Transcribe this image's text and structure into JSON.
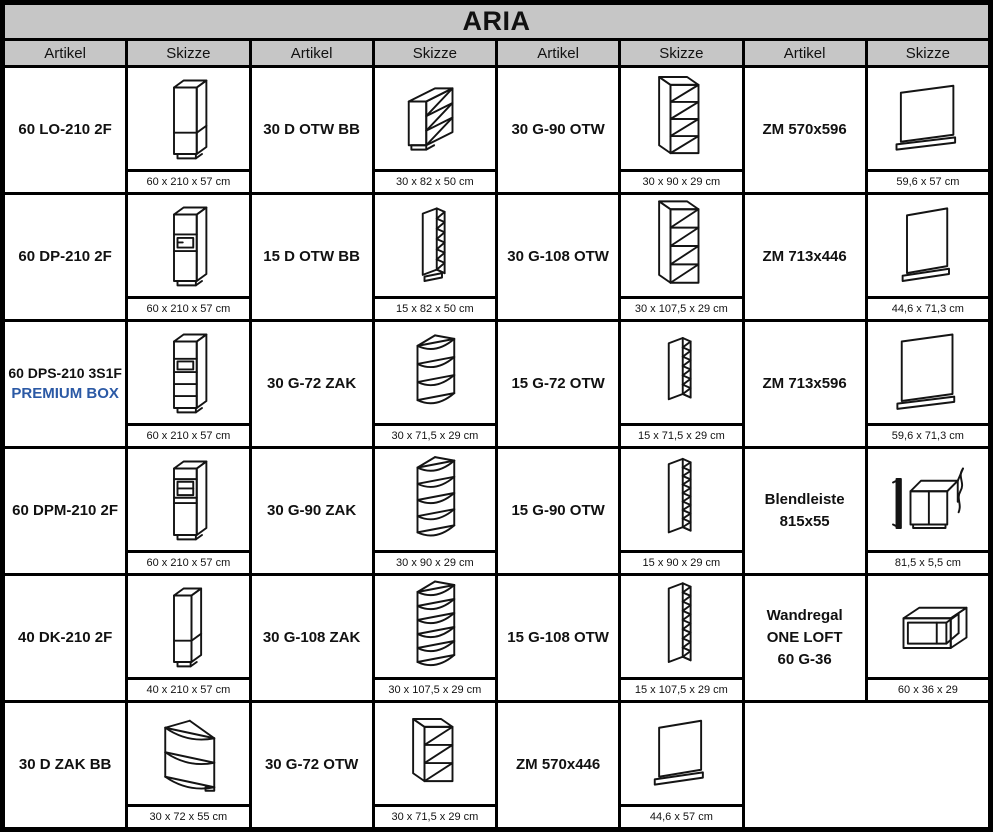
{
  "title": "ARIA",
  "columns": [
    "Artikel",
    "Skizze",
    "Artikel",
    "Skizze",
    "Artikel",
    "Skizze",
    "Artikel",
    "Skizze"
  ],
  "colors": {
    "accent_blue": "#2b59a5",
    "header_bg": "#c6c6c6",
    "grid_line": "#000000",
    "cell_bg": "#ffffff",
    "sketch_stroke": "#141414"
  },
  "rows": [
    [
      {
        "lines": [
          {
            "text": "60 LO-210 2F",
            "accent": false
          }
        ],
        "icon": "tall-cabinet-sketch",
        "sketch": {
          "kind": "tall",
          "variant": "2f",
          "w": 26
        },
        "dims": "60 x 210 x 57 cm"
      },
      {
        "lines": [
          {
            "text": "30 D OTW BB",
            "accent": false
          }
        ],
        "icon": "base-open-shelf-sketch",
        "sketch": {
          "kind": "base-open"
        },
        "dims": "30 x 82 x 50 cm"
      },
      {
        "lines": [
          {
            "text": "30 G-90 OTW",
            "accent": false
          }
        ],
        "icon": "wall-open-shelf-sketch",
        "sketch": {
          "kind": "wall-open",
          "n": 4,
          "h": 78
        },
        "dims": "30 x 90 x 29 cm"
      },
      {
        "lines": [
          {
            "text": "ZM 570x596",
            "accent": false
          }
        ],
        "icon": "cover-panel-sketch",
        "sketch": {
          "kind": "panel",
          "w": 60,
          "h": 56
        },
        "dims": "59,6 x 57 cm"
      }
    ],
    [
      {
        "lines": [
          {
            "text": "60 DP-210 2F",
            "accent": false
          }
        ],
        "icon": "tall-cabinet-sketch",
        "sketch": {
          "kind": "tall",
          "variant": "oven",
          "w": 26
        },
        "dims": "60 x 210 x 57 cm"
      },
      {
        "lines": [
          {
            "text": "15 D OTW BB",
            "accent": false
          }
        ],
        "icon": "narrow-open-shelf-sketch",
        "sketch": {
          "kind": "wall-narrow",
          "n": 6,
          "h": 70,
          "plinth": true
        },
        "dims": "15 x 82 x 50 cm"
      },
      {
        "lines": [
          {
            "text": "30 G-108 OTW",
            "accent": false
          }
        ],
        "icon": "wall-open-shelf-sketch",
        "sketch": {
          "kind": "wall-open",
          "n": 4,
          "h": 84
        },
        "dims": "30 x 107,5 x 29 cm"
      },
      {
        "lines": [
          {
            "text": "ZM 713x446",
            "accent": false
          }
        ],
        "icon": "cover-panel-sketch",
        "sketch": {
          "kind": "panel",
          "w": 46,
          "h": 66
        },
        "dims": "44,6 x 71,3 cm"
      }
    ],
    [
      {
        "lines": [
          {
            "text": "60 DPS-210 3S1F",
            "accent": false
          },
          {
            "text": "PREMIUM BOX",
            "accent": true
          }
        ],
        "icon": "tall-cabinet-sketch",
        "sketch": {
          "kind": "tall",
          "variant": "ovendrawers",
          "w": 26
        },
        "dims": "60 x 210 x 57 cm"
      },
      {
        "lines": [
          {
            "text": "30 G-72 ZAK",
            "accent": false
          }
        ],
        "icon": "corner-shelf-sketch",
        "sketch": {
          "kind": "corner-zak",
          "n": 4,
          "h": 62
        },
        "dims": "30 x 71,5 x 29 cm"
      },
      {
        "lines": [
          {
            "text": "15 G-72 OTW",
            "accent": false
          }
        ],
        "icon": "narrow-open-shelf-sketch",
        "sketch": {
          "kind": "wall-narrow",
          "n": 6,
          "h": 64
        },
        "dims": "15 x 71,5 x 29 cm"
      },
      {
        "lines": [
          {
            "text": "ZM 713x596",
            "accent": false
          }
        ],
        "icon": "cover-panel-sketch",
        "sketch": {
          "kind": "panel",
          "w": 58,
          "h": 68
        },
        "dims": "59,6 x 71,3 cm"
      }
    ],
    [
      {
        "lines": [
          {
            "text": "60 DPM-210 2F",
            "accent": false
          }
        ],
        "icon": "tall-cabinet-sketch",
        "sketch": {
          "kind": "tall",
          "variant": "mw",
          "w": 26
        },
        "dims": "60 x 210 x 57 cm"
      },
      {
        "lines": [
          {
            "text": "30 G-90 ZAK",
            "accent": false
          }
        ],
        "icon": "corner-shelf-sketch",
        "sketch": {
          "kind": "corner-zak",
          "n": 5,
          "h": 74
        },
        "dims": "30 x 90 x 29 cm"
      },
      {
        "lines": [
          {
            "text": "15 G-90 OTW",
            "accent": false
          }
        ],
        "icon": "narrow-open-shelf-sketch",
        "sketch": {
          "kind": "wall-narrow",
          "n": 8,
          "h": 78
        },
        "dims": "15 x 90 x 29 cm"
      },
      {
        "lines": [
          {
            "text": "Blendleiste",
            "accent": false
          },
          {
            "text": "815x55",
            "accent": false
          }
        ],
        "icon": "blendleiste-sketch",
        "sketch": {
          "kind": "blendleiste"
        },
        "dims": "81,5 x 5,5 cm"
      }
    ],
    [
      {
        "lines": [
          {
            "text": "40 DK-210 2F",
            "accent": false
          }
        ],
        "icon": "tall-cabinet-sketch",
        "sketch": {
          "kind": "tall",
          "variant": "2f",
          "w": 20
        },
        "dims": "40 x 210 x 57 cm"
      },
      {
        "lines": [
          {
            "text": "30 G-108 ZAK",
            "accent": false
          }
        ],
        "icon": "corner-shelf-sketch",
        "sketch": {
          "kind": "corner-zak",
          "n": 6,
          "h": 80
        },
        "dims": "30 x 107,5 x 29 cm"
      },
      {
        "lines": [
          {
            "text": "15 G-108 OTW",
            "accent": false
          }
        ],
        "icon": "narrow-open-shelf-sketch",
        "sketch": {
          "kind": "wall-narrow",
          "n": 8,
          "h": 84
        },
        "dims": "15 x 107,5 x 29 cm"
      },
      {
        "lines": [
          {
            "text": "Wandregal",
            "accent": false
          },
          {
            "text": "ONE LOFT",
            "accent": false
          },
          {
            "text": "60 G-36",
            "accent": false
          }
        ],
        "icon": "wall-shelf-frame-sketch",
        "sketch": {
          "kind": "wandregal"
        },
        "dims": "60 x 36 x 29"
      }
    ],
    [
      {
        "lines": [
          {
            "text": "30 D ZAK BB",
            "accent": false
          }
        ],
        "icon": "corner-base-shelf-sketch",
        "sketch": {
          "kind": "base-zak"
        },
        "dims": "30 x 72 x 55 cm"
      },
      {
        "lines": [
          {
            "text": "30 G-72 OTW",
            "accent": false
          }
        ],
        "icon": "wall-open-shelf-sketch",
        "sketch": {
          "kind": "wall-open",
          "n": 3,
          "h": 62
        },
        "dims": "30 x 71,5 x 29 cm"
      },
      {
        "lines": [
          {
            "text": "ZM 570x446",
            "accent": false
          }
        ],
        "icon": "cover-panel-sketch",
        "sketch": {
          "kind": "panel",
          "w": 48,
          "h": 56
        },
        "dims": "44,6 x 57 cm"
      },
      {
        "empty": true
      }
    ]
  ]
}
